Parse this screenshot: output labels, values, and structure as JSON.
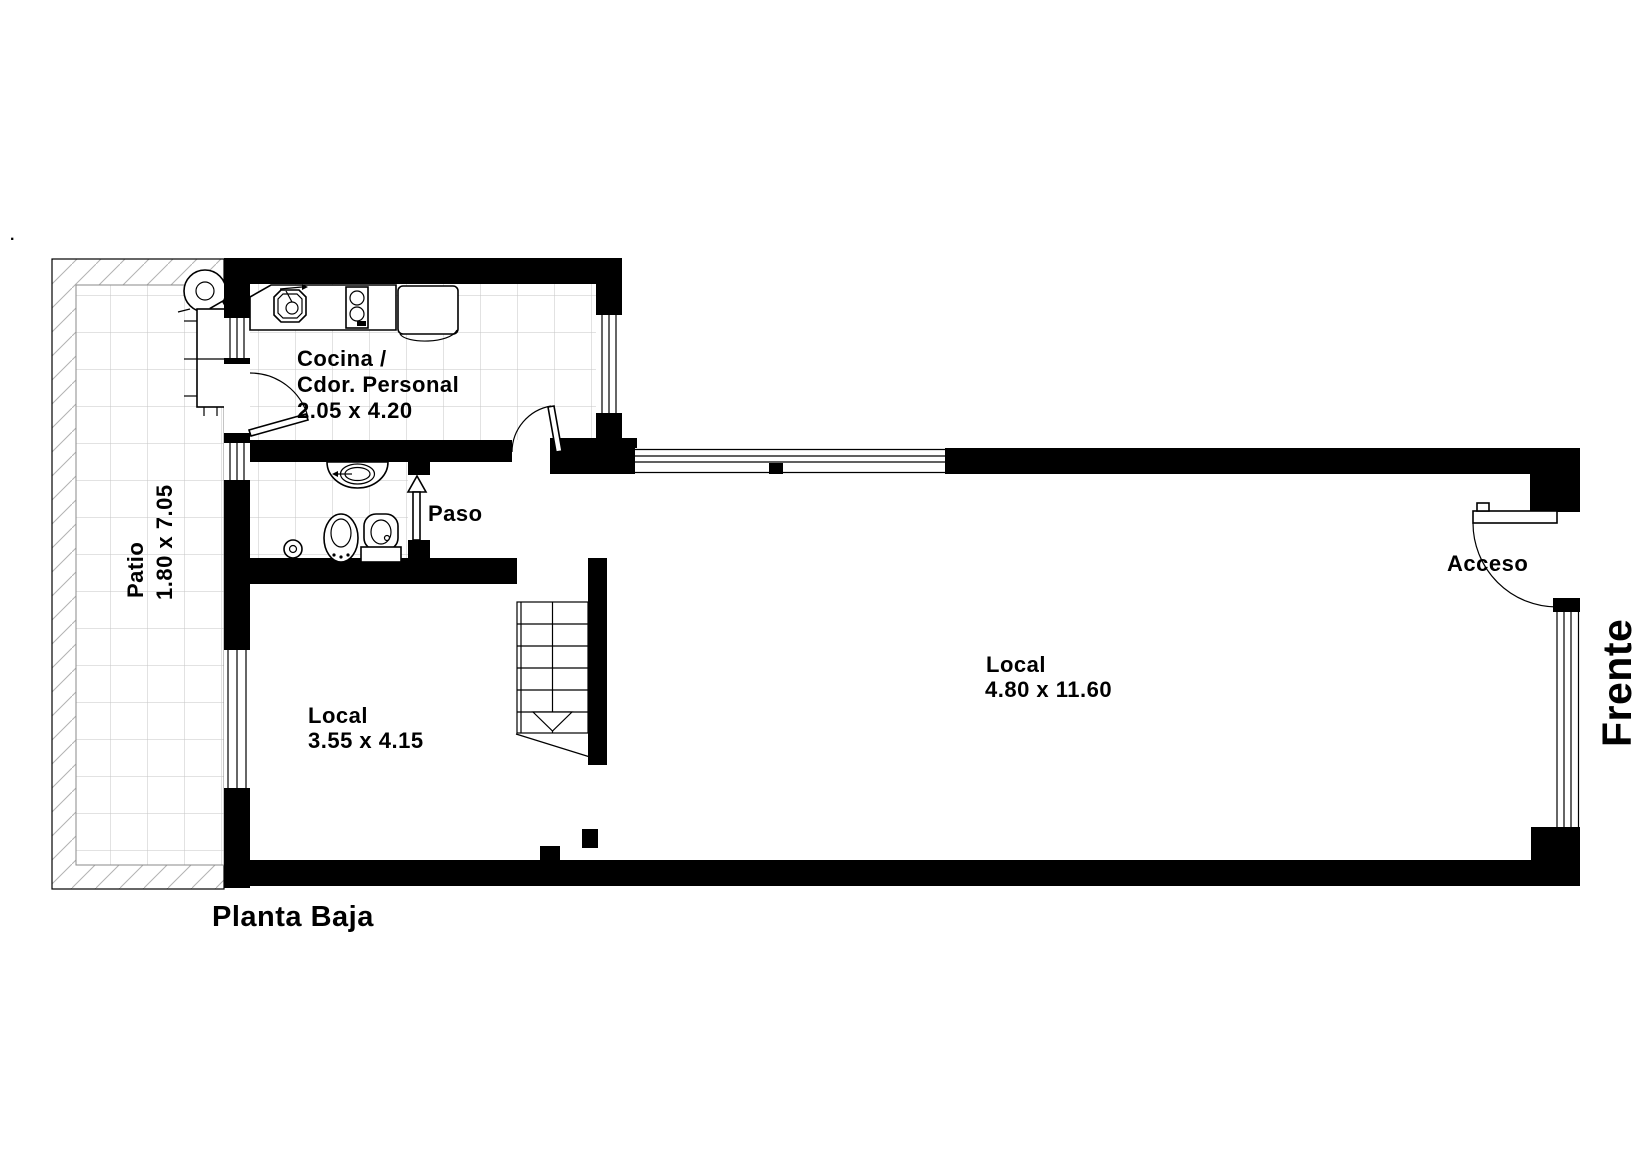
{
  "plan": {
    "floor_title": "Planta Baja",
    "front_label": "Frente",
    "stray_mark": ".",
    "rooms": {
      "patio": {
        "name": "Patio",
        "dims": "1.80 x 7.05"
      },
      "kitchen": {
        "line1": "Cocina /",
        "line2": "Cdor. Personal",
        "dims": "2.05 x 4.20"
      },
      "hallway": {
        "name": "Paso"
      },
      "shop_small": {
        "name": "Local",
        "dims": "3.55 x 4.15"
      },
      "shop_main": {
        "name": "Local",
        "dims": "4.80 x 11.60"
      },
      "entrance": {
        "name": "Acceso"
      }
    },
    "fixtures": [
      "water-heater-icon",
      "laundry-sink-icon",
      "kitchen-sink-icon",
      "stove-icon",
      "refrigerator-icon",
      "vanity-sink-icon",
      "bidet-icon",
      "toilet-icon",
      "shower-icon",
      "stairs-down",
      "door-swing"
    ],
    "colors": {
      "wall": "#000000",
      "tile_grid": "#c6c6c6",
      "hatch": "#b2b2b2",
      "paper": "#ffffff"
    }
  }
}
